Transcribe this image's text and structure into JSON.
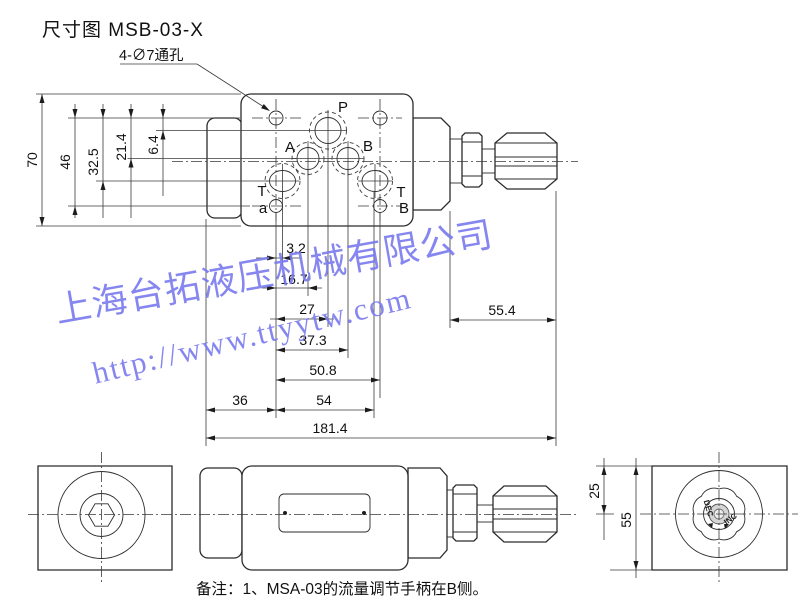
{
  "title": "尺寸图 MSB-03-X",
  "callout": "4-∅7通孔",
  "ports": {
    "p": "P",
    "a_port": "A",
    "b_port": "B",
    "t_left": "T",
    "t_right": "T",
    "drain": "a",
    "b_bottom": "B"
  },
  "dims": {
    "h70": "70",
    "h46": "46",
    "h32_5": "32.5",
    "h21_4": "21.4",
    "h6_4": "6.4",
    "w3_2": "3.2",
    "w16_7": "16.7",
    "w27": "27",
    "w37_3": "37.3",
    "w50_8": "50.8",
    "w36": "36",
    "w54": "54",
    "w181_4": "181.4",
    "w55_4": "55.4",
    "s25": "25",
    "s55": "55"
  },
  "knob": {
    "dec": "DEC",
    "inc": "INC"
  },
  "watermark": {
    "line1": "上海台拓液压机械有限公司",
    "line2": "http://www.ttyytw.com"
  },
  "note": "备注：1、MSA-03的流量调节手柄在B侧。"
}
